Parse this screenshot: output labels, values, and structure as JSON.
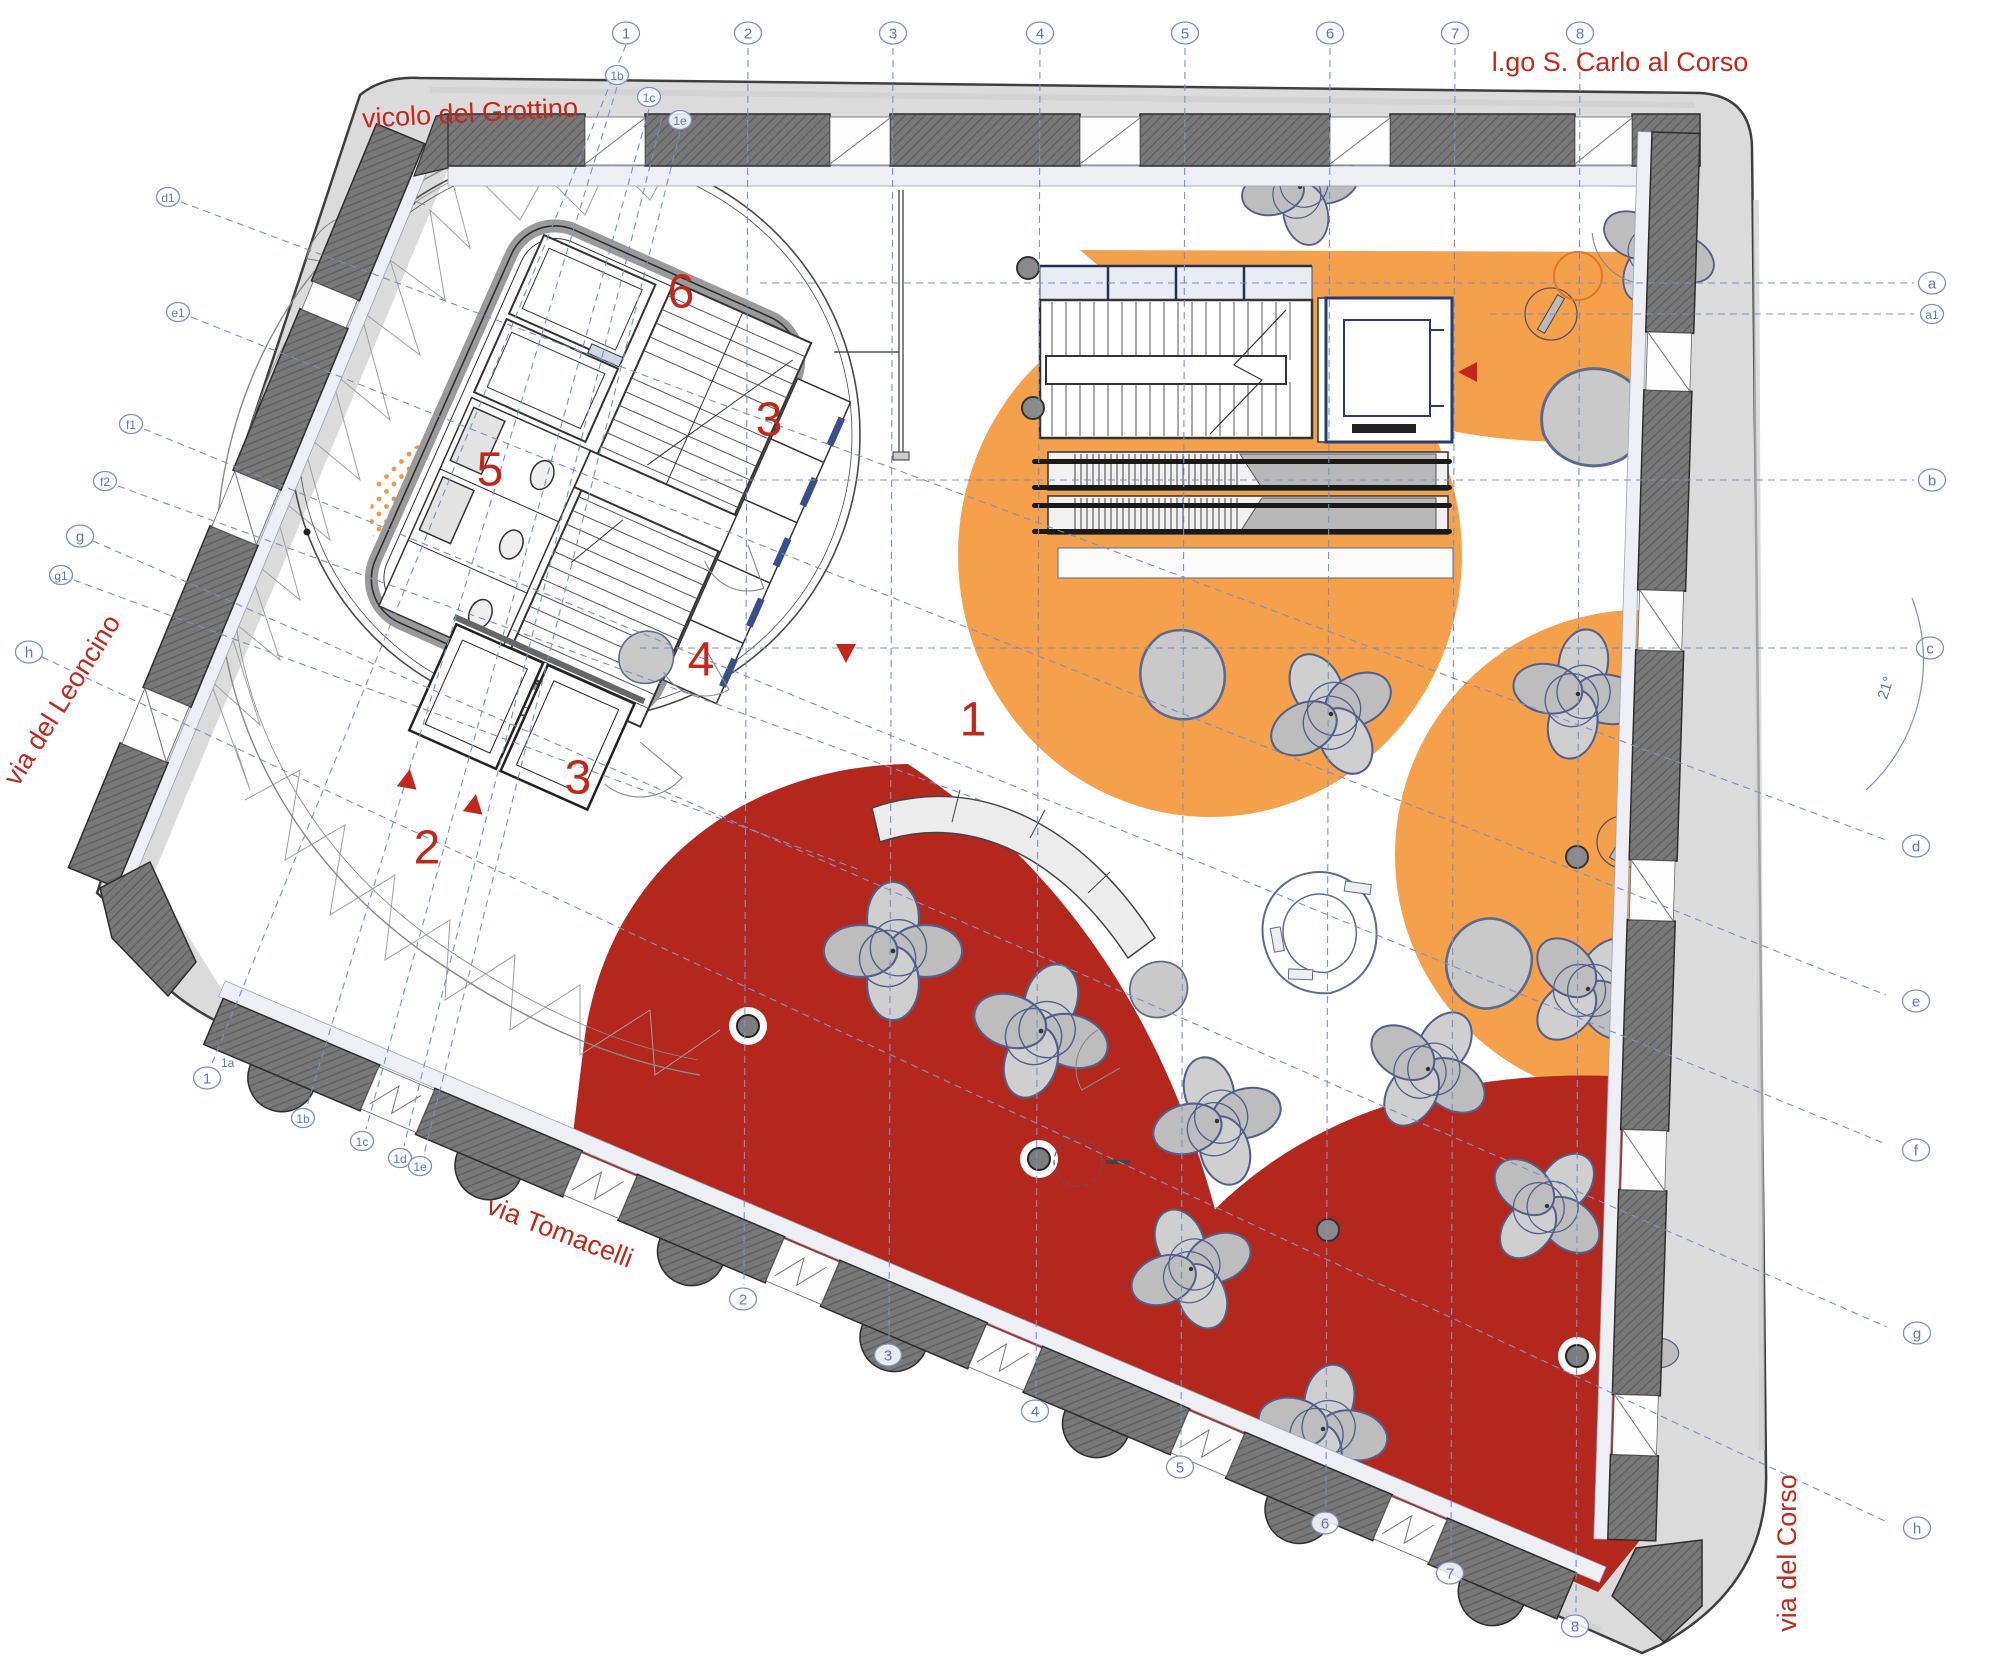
{
  "title": "ground floor plan",
  "colors": {
    "label_red": "#c3271b",
    "zone_red": "#b3271d",
    "zone_orange": "#f5a14b",
    "grid_blue": "#7c90c6",
    "grid_text_blue": "#5b76bf",
    "sidewalk_gray": "#dbdbdb",
    "wall_dark_gray": "#757575",
    "sill_light": "#edeff4",
    "furniture_gray": "#c9c9c9",
    "truss_gray": "#9f9f9f"
  },
  "streets": [
    {
      "id": "vicolo-del-grottino",
      "label": "vicolo del Grottino"
    },
    {
      "id": "lgo-s-carlo-al-corso",
      "label": "l.go S. Carlo al Corso"
    },
    {
      "id": "via-del-leoncino",
      "label": "via del Leoncino"
    },
    {
      "id": "via-tomacelli",
      "label": "via Tomacelli"
    },
    {
      "id": "via-del-corso",
      "label": "via del Corso"
    }
  ],
  "zones": [
    {
      "id": "zone-1",
      "n": "1",
      "x": 973,
      "y": 720
    },
    {
      "id": "zone-2",
      "n": "2",
      "x": 427,
      "y": 848
    },
    {
      "id": "zone-3a",
      "n": "3",
      "x": 578,
      "y": 778
    },
    {
      "id": "zone-3b",
      "n": "3",
      "x": 769,
      "y": 420
    },
    {
      "id": "zone-4",
      "n": "4",
      "x": 701,
      "y": 660
    },
    {
      "id": "zone-5",
      "n": "5",
      "x": 490,
      "y": 470
    },
    {
      "id": "zone-6",
      "n": "6",
      "x": 681,
      "y": 292
    }
  ],
  "annotations": {
    "angle": "21°"
  },
  "grid": {
    "verticals": [
      {
        "n": "2",
        "x": 748,
        "yb": 1299
      },
      {
        "n": "3",
        "x": 893,
        "yb": 1355
      },
      {
        "n": "4",
        "x": 1040,
        "yb": 1411
      },
      {
        "n": "5",
        "x": 1185,
        "yb": 1467
      },
      {
        "n": "6",
        "x": 1330,
        "yb": 1523
      },
      {
        "n": "7",
        "x": 1455,
        "yb": 1573
      },
      {
        "n": "8",
        "x": 1580,
        "yb": 1626
      }
    ],
    "slanted": [
      {
        "tn": "1",
        "tx": 626,
        "ty": 33,
        "bn": "1",
        "bx": 207,
        "by": 1078,
        "sup": "1a"
      },
      {
        "tn": "1b",
        "tx": 617,
        "ty": 75,
        "bn": "1b",
        "bx": 303,
        "by": 1118,
        "sup": ""
      },
      {
        "tn": "1c",
        "tx": 649,
        "ty": 97,
        "bn": "1c",
        "bx": 362,
        "by": 1141,
        "sup": ""
      },
      {
        "tn": "",
        "tx": 662,
        "ty": 106,
        "bn": "1d",
        "bx": 400,
        "by": 1158,
        "sup": ""
      },
      {
        "tn": "1e",
        "tx": 680,
        "ty": 120,
        "bn": "1e",
        "bx": 420,
        "by": 1166,
        "sup": ""
      }
    ],
    "letters_right": [
      {
        "n": "a",
        "x": 1932,
        "y": 283,
        "x1": 760
      },
      {
        "n": "a1",
        "x": 1932,
        "y": 314,
        "x1": 1490
      },
      {
        "n": "b",
        "x": 1932,
        "y": 480,
        "x1": 700
      },
      {
        "n": "c",
        "x": 1930,
        "y": 648,
        "x1": 640
      }
    ],
    "letters_slanted": [
      {
        "ln": "d1",
        "lx": 168,
        "ly": 197,
        "rn": "d",
        "rx": 1902,
        "ry": 846
      },
      {
        "ln": "e1",
        "lx": 178,
        "ly": 312,
        "rn": "e",
        "rx": 1902,
        "ry": 1001
      },
      {
        "ln": "f1",
        "lx": 131,
        "ly": 424,
        "rn": "f",
        "rx": 1902,
        "ry": 1150
      },
      {
        "ln": "f2",
        "lx": 105,
        "ly": 481,
        "rn": "",
        "rx": 980,
        "ry": 800
      },
      {
        "ln": "g",
        "lx": 80,
        "ly": 536,
        "rn": "g",
        "rx": 1903,
        "ry": 1333
      },
      {
        "ln": "g1",
        "lx": 61,
        "ly": 575,
        "rn": "",
        "rx": 860,
        "ry": 870
      },
      {
        "ln": "h",
        "lx": 29,
        "ly": 652,
        "rn": "h",
        "rx": 1903,
        "ry": 1528
      }
    ]
  },
  "markers": [
    {
      "x": 408,
      "y": 780,
      "rot": 10
    },
    {
      "x": 474,
      "y": 805,
      "rot": 10
    },
    {
      "x": 846,
      "y": 652,
      "rot": 180
    },
    {
      "x": 1469,
      "y": 372,
      "rot": -90
    }
  ],
  "furniture": {
    "flower_tables": [
      {
        "x": 1300,
        "y": 187,
        "rot": -12,
        "s": 0.92
      },
      {
        "x": 1659,
        "y": 247,
        "rot": 25,
        "s": 0.92
      },
      {
        "x": 1578,
        "y": 694,
        "rot": 10,
        "s": 1.02
      },
      {
        "x": 1331,
        "y": 714,
        "rot": -28,
        "s": 1.02
      },
      {
        "x": 1588,
        "y": 989,
        "rot": 45,
        "s": 1.0
      },
      {
        "x": 893,
        "y": 951,
        "rot": 0,
        "s": 1.08
      },
      {
        "x": 1041,
        "y": 1031,
        "rot": 18,
        "s": 1.08
      },
      {
        "x": 1217,
        "y": 1121,
        "rot": -15,
        "s": 1.02
      },
      {
        "x": 1428,
        "y": 1069,
        "rot": 33,
        "s": 1.0
      },
      {
        "x": 1191,
        "y": 1269,
        "rot": -22,
        "s": 0.98
      },
      {
        "x": 1323,
        "y": 1429,
        "rot": 12,
        "s": 1.02
      },
      {
        "x": 1547,
        "y": 1206,
        "rot": 40,
        "s": 0.98
      },
      {
        "x": 1639,
        "y": 1353,
        "rot": 0,
        "s": 0.62
      }
    ],
    "pebble_seats": [
      {
        "x": 1595,
        "y": 417,
        "s": 1.5,
        "rot": 15
      },
      {
        "x": 1183,
        "y": 676,
        "s": 1.3,
        "rot": 95
      },
      {
        "x": 1489,
        "y": 962,
        "s": 1.3,
        "rot": -50
      },
      {
        "x": 647,
        "y": 657,
        "s": 0.8,
        "rot": 0
      },
      {
        "x": 1158,
        "y": 990,
        "s": 0.85,
        "rot": 170
      }
    ],
    "trefoil_pod": {
      "x": 1320,
      "y": 934,
      "rot": -10
    },
    "columns_dark": [
      {
        "x": 1028,
        "y": 268
      },
      {
        "x": 1033,
        "y": 408
      },
      {
        "x": 1577,
        "y": 857
      },
      {
        "x": 1328,
        "y": 1230
      }
    ],
    "columns_ringed": [
      {
        "x": 748,
        "y": 1026
      },
      {
        "x": 1039,
        "y": 1159
      },
      {
        "x": 1577,
        "y": 1356
      }
    ],
    "slash_circles": [
      {
        "x": 1551,
        "y": 314,
        "r": 26
      },
      {
        "x": 1623,
        "y": 842,
        "r": 26
      }
    ],
    "dashed_circle": {
      "x": 1078,
      "y": 1162,
      "r": 24
    },
    "orange_ring": {
      "x": 1578,
      "y": 276,
      "r": 24
    }
  },
  "door_arcs": [
    {
      "x": 360,
      "y": 268,
      "r": 54,
      "a0": 190,
      "a1": 280
    },
    {
      "x": 425,
      "y": 205,
      "r": 46,
      "a0": 200,
      "a1": 290
    },
    {
      "x": 300,
      "y": 450,
      "r": 55,
      "a0": 150,
      "a1": 240
    },
    {
      "x": 640,
      "y": 742,
      "r": 55,
      "a0": 40,
      "a1": 130
    },
    {
      "x": 705,
      "y": 648,
      "r": 48,
      "a0": 60,
      "a1": 150
    },
    {
      "x": 748,
      "y": 545,
      "r": 46,
      "a0": 70,
      "a1": 160
    },
    {
      "x": 1648,
      "y": 228,
      "r": 56,
      "a0": 95,
      "a1": 175
    },
    {
      "x": 1120,
      "y": 1068,
      "r": 44,
      "a0": 150,
      "a1": 240
    }
  ]
}
